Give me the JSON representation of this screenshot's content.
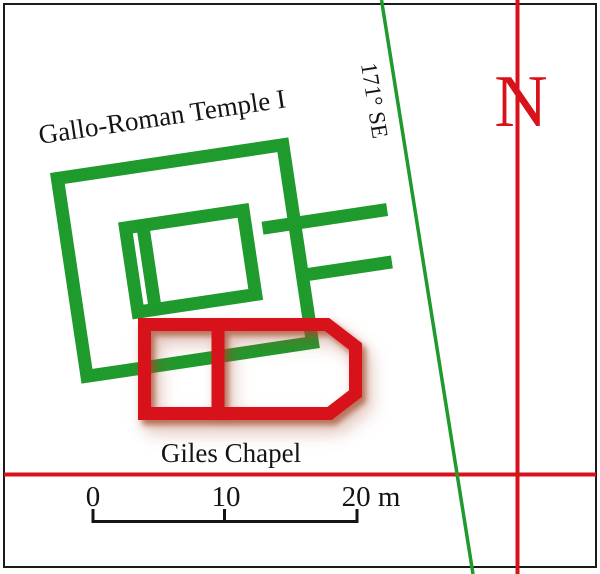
{
  "plan": {
    "temple_label": "Gallo-Roman Temple I",
    "chapel_label": "Giles Chapel",
    "bearing_label": "171° SE",
    "north_label": "N",
    "scale_bar": {
      "tick_labels": [
        "0",
        "10",
        "20 m"
      ]
    },
    "colors": {
      "green": "#1F9A2D",
      "red": "#D8121A",
      "shadow": "rgba(164,72,42,0.7)",
      "shadow_soft": "rgba(164,72,42,0.35)",
      "text": "#141414",
      "border": "#1B1B1B",
      "background": "#FFFFFF"
    }
  }
}
